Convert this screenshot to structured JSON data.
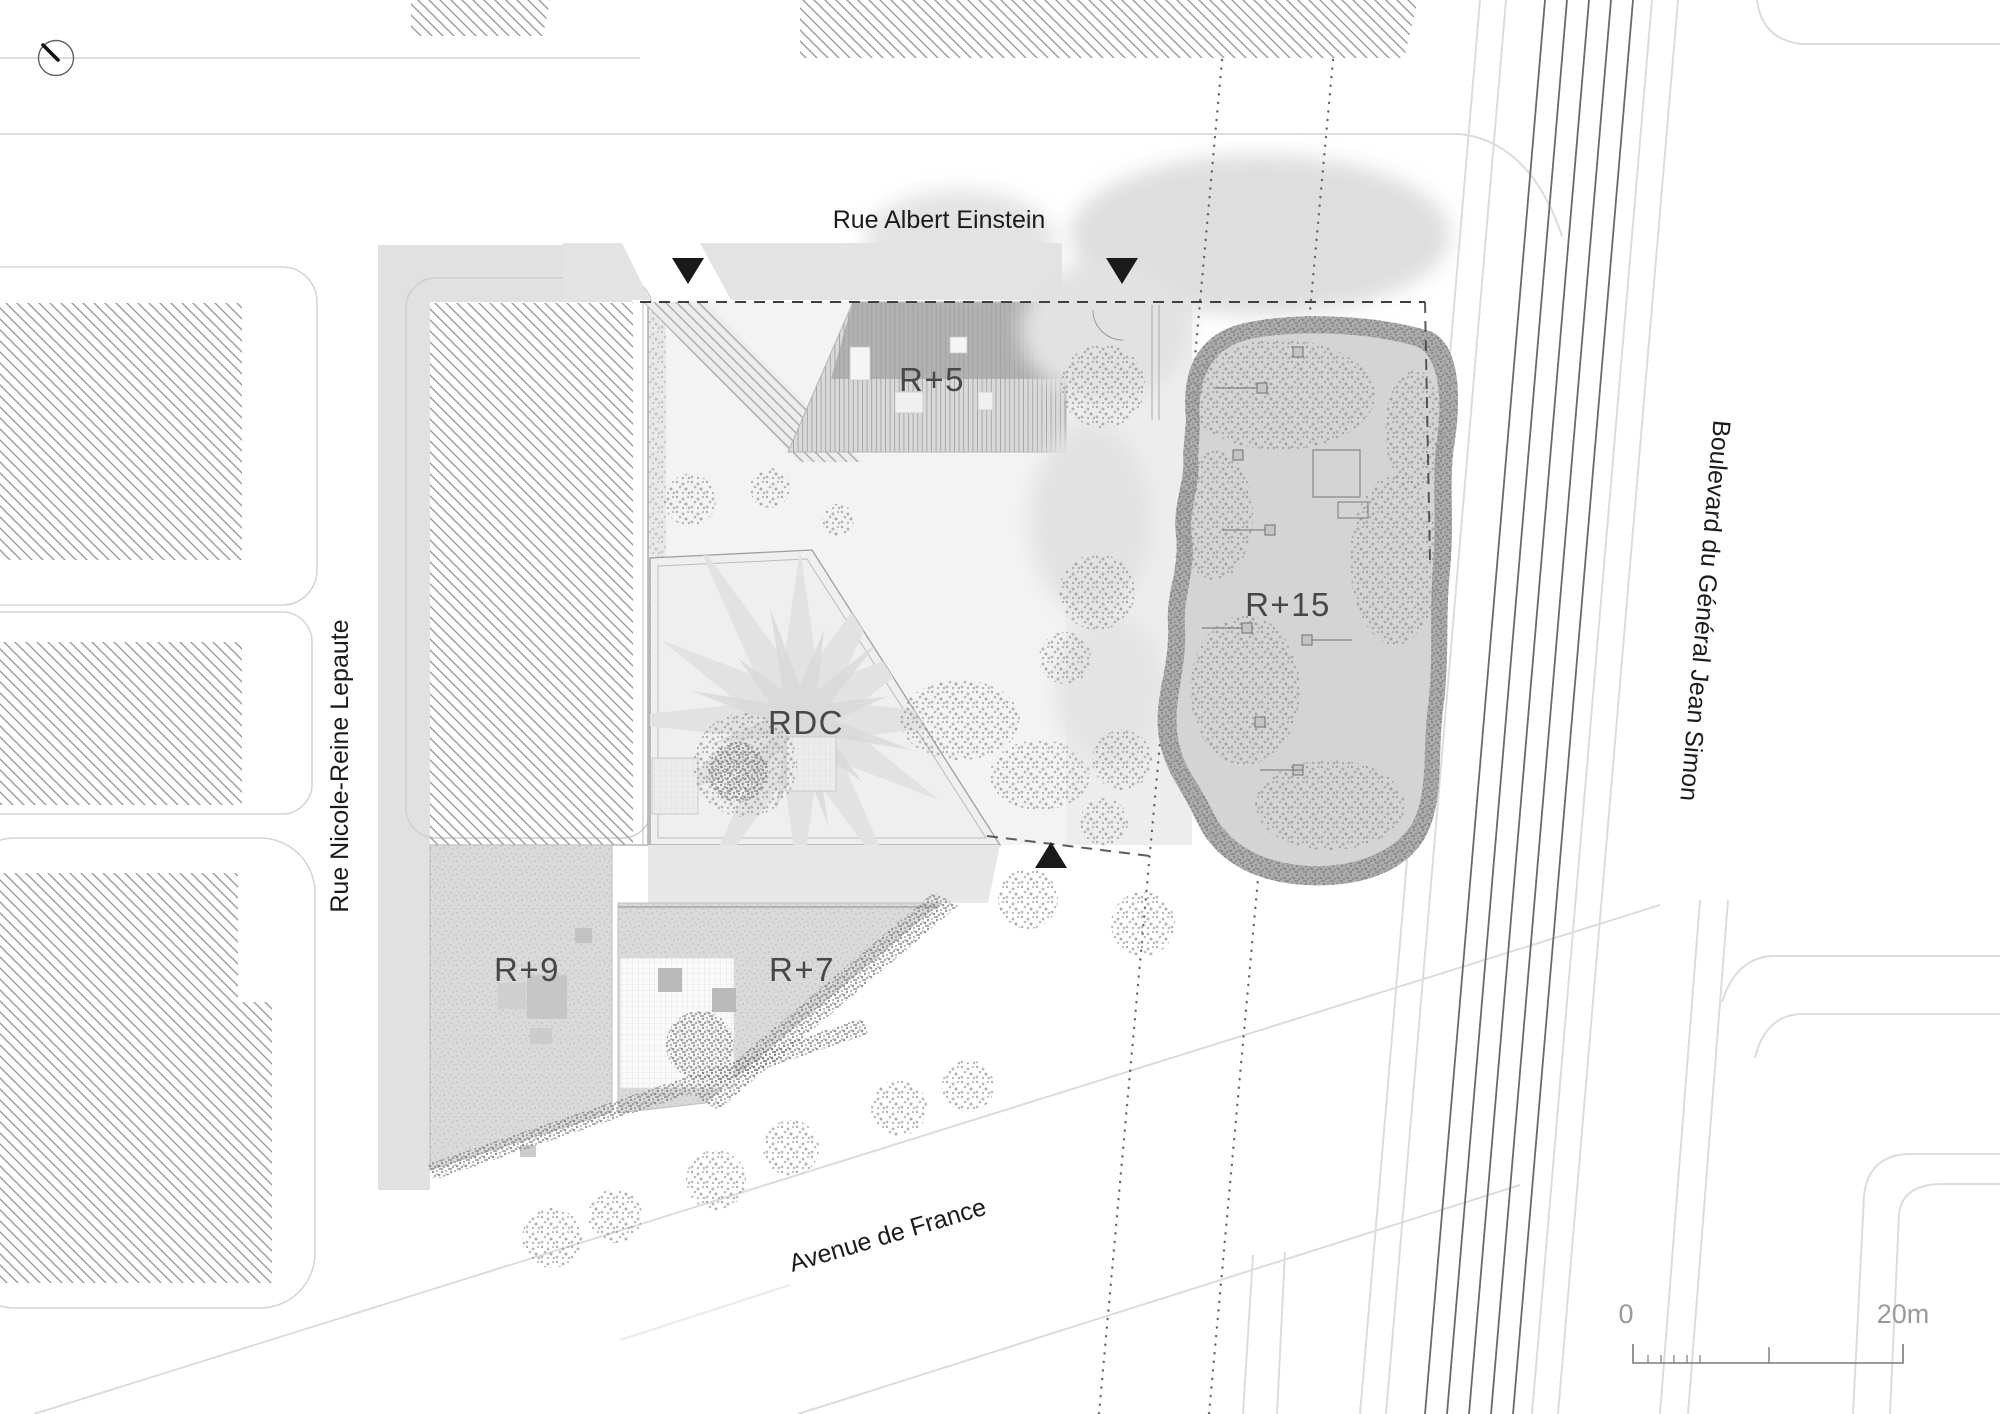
{
  "drawing": {
    "type": "architectural-site-plan",
    "level_shown": "roof plan"
  },
  "streets": {
    "north": "Rue Albert Einstein",
    "west": "Rue Nicole-Reine Lepaute",
    "east": "Boulevard du Général Jean Simon",
    "south": "Avenue de France"
  },
  "buildings": {
    "r5": "R+5",
    "r15": "R+15",
    "rdc": "RDC",
    "r9": "R+9",
    "r7": "R+7"
  },
  "scale_bar": {
    "start": "0",
    "end": "20m"
  },
  "icons": {
    "north_arrow": "north-arrow",
    "entrance_marker": "site-entrance-triangle"
  },
  "colors": {
    "background": "#ffffff",
    "street_linework": "#dcdcdc",
    "hatch": "#9a9a9a",
    "gray_mass": "#e1e1e1",
    "rail_dark": "#6a6a6a",
    "site_boundary_dashed": "#3f3f3f",
    "marker_black": "#1a1a1a",
    "street_label_ink": "#1b1b1b",
    "building_label_ink": "#474747",
    "scale_ink": "#9a9a9a"
  }
}
